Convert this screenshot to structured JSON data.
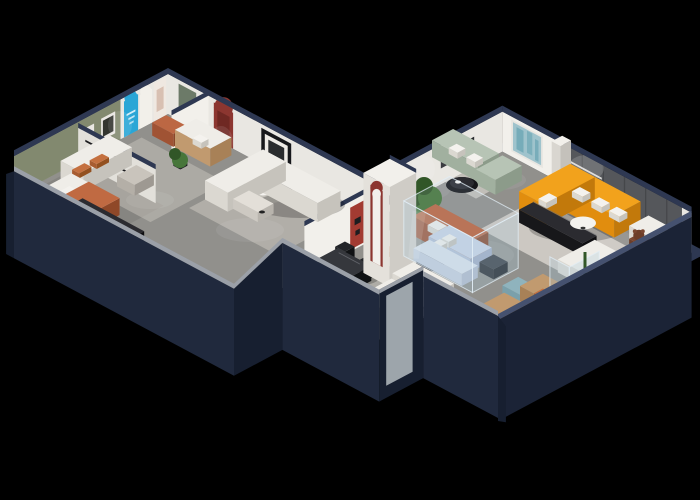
{
  "meta": {
    "title": "3D isometric furniture showroom floor-plan render",
    "canvas_width": 700,
    "canvas_height": 500
  },
  "scene": {
    "description": "Isometric cutaway render of an L-shaped furniture showroom floating on a black background. Tall dark-navy exterior walls wrap spotlit gray floors. The left wing holds a lounge with a sage-green accent wall and framed art, arched display niches including a cyan poster arch and a woman poster, a terracotta ottoman, tan sofa, a bedroom vignette with orange bedding and a black media cabinet, and a living set with a white sectional sofa, coffee table and orange armchair beside red arched niches. The center gallery has a black dining table with chairs, an arc floor lamp, a white column with a dark-red arch, potted trees, a terracotta sofa with white cushions, black oval tables and a glass display room furnished in pale blue. The right wing showroom features an orange sectional sofa with white pillows against a charcoal feature wall with a lit slogan, a teal abstract painting, a sage-green sofa and chaise with a black round table, black media consoles, white armchairs, a teddy-bear figure, a white chaise, teal benches and a glass display case with plants.",
    "rooms": [
      {
        "name": "left-wing-lounge",
        "furniture": [
          "white-sofa",
          "orange-cushions",
          "coffee-table",
          "potted-plant",
          "terracotta-ottoman",
          "tan-sofa",
          "round-side-table",
          "green-accent-wall",
          "cyan-poster-arch",
          "woman-poster-arch",
          "green-door"
        ]
      },
      {
        "name": "left-wing-bedroom",
        "furniture": [
          "bed-orange-bedding",
          "black-media-cabinet",
          "wall-shelf"
        ]
      },
      {
        "name": "left-wing-living-room",
        "furniture": [
          "white-sectional-sofa",
          "coffee-table",
          "orange-armchair",
          "black-frame-art",
          "red-arch-niche",
          "red-panel-wall"
        ]
      },
      {
        "name": "center-gallery",
        "furniture": [
          "black-dining-table",
          "dining-chairs",
          "arc-floor-lamp",
          "red-arch-column",
          "potted-tree",
          "white-armchair",
          "terracotta-sofa",
          "black-oval-table",
          "white-sofa-group",
          "glass-display-room",
          "pale-blue-bed",
          "pale-blue-sofa"
        ]
      },
      {
        "name": "right-wing-showroom",
        "furniture": [
          "orange-sectional-sofa",
          "slogan-feature-wall",
          "teal-wall-art",
          "sage-green-sofa",
          "sage-chaise",
          "black-round-table",
          "black-media-console",
          "white-round-table",
          "white-armchair",
          "teddy-bear-figure",
          "white-chaise",
          "teal-bench",
          "tan-armchair",
          "glass-display-case"
        ]
      }
    ]
  },
  "palette": {
    "bg": "#000000",
    "navyCap": "#2e3852",
    "navyCapLight": "#45516f",
    "slabFace": "#20293d",
    "slabDark": "#171f30",
    "slabEast": "#1b2336",
    "capLit": "#9ba0a8",
    "wallWhite": "#e9e7e2",
    "wallWhiteLit": "#f2f0eb",
    "wallGreen": "#82896f",
    "wallDark": "#55575b",
    "doorGreen": "#6c7a68",
    "accentCyan": "#2aa6d6",
    "accentRed": "#8c3630",
    "redDark": "#6f2823",
    "floor": "#91908c",
    "floorDark": "#7d7c78",
    "rug": "#c7c3bb",
    "rugLight": "#d6d2cb",
    "sofaWhiteTop": "#efede8",
    "sofaWhiteSw": "#dbd8d1",
    "sofaWhiteSe": "#c6c3bc",
    "orangeTop": "#f2a21c",
    "orangeSw": "#e18d0e",
    "orangeSe": "#c2790b",
    "terracottaTop": "#bc6743",
    "terracottaSw": "#a05334",
    "terracottaSe": "#8a4629",
    "tanTop": "#c19a6f",
    "tanSw": "#a88157",
    "tanSe": "#8f6c47",
    "sageTop": "#b7c4b5",
    "sageSw": "#a1b09f",
    "sageSe": "#8c9b8a",
    "tealTop": "#8fb3bd",
    "tealSw": "#7aa0ab",
    "tealSe": "#688e99",
    "blackTop": "#2b2b30",
    "blackSw": "#17171a",
    "blackSe": "#0e0e11",
    "paleBlueTop": "#ccd6e8",
    "paleBlueSw": "#b6c2d8",
    "paleBlueSe": "#a2aec6",
    "glass": "rgba(170,200,218,0.28)",
    "glassEdge": "rgba(225,238,246,0.75)",
    "plant": "#47763a",
    "plantDark": "#315627",
    "potDark": "#303034",
    "bear": "#7a4630",
    "bearDark": "#6d3d28",
    "artTeal": "#9fc3cc",
    "artTealDark": "#6fa8b5",
    "white": "#f4f2ee",
    "glow": "rgba(255,255,255,0.12)",
    "shadow": "rgba(0,0,0,0.22)"
  }
}
